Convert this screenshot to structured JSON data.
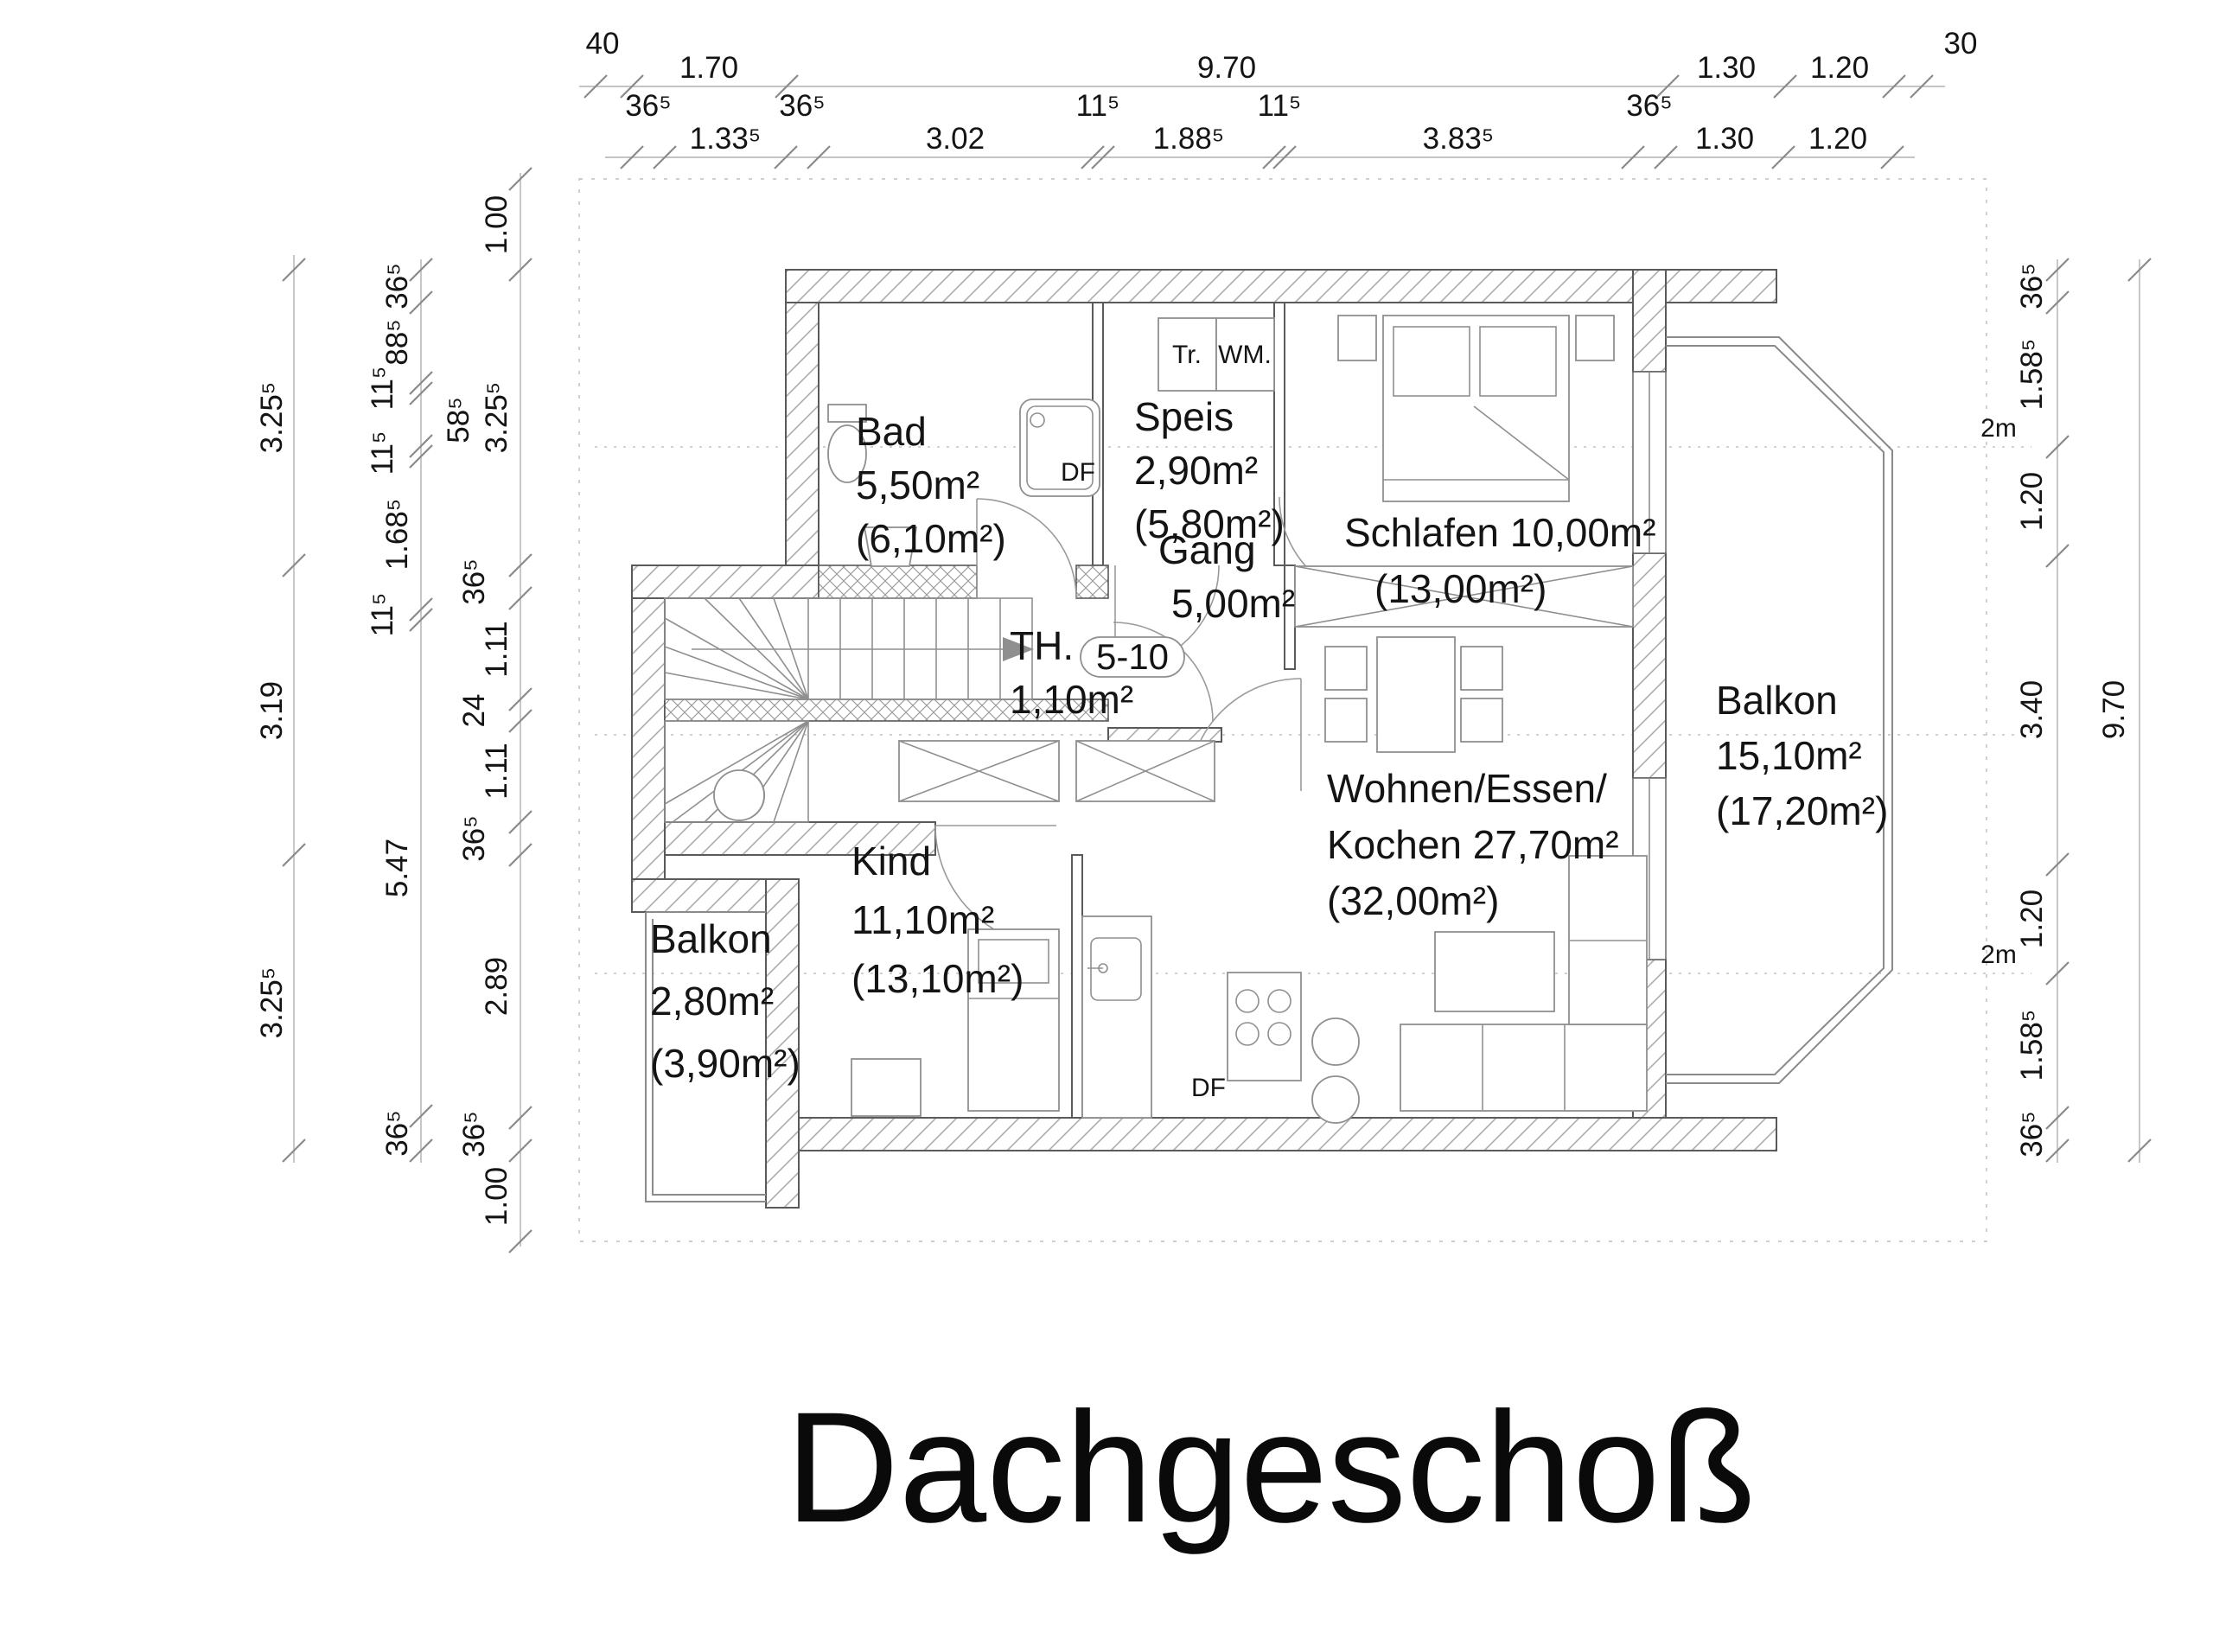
{
  "title": "Dachgeschoß",
  "dims": {
    "top": {
      "corner_left": "40",
      "corner_right": "30",
      "row1": [
        "1.70",
        "9.70",
        "1.30",
        "1.20"
      ],
      "row2": [
        "36⁵",
        "36⁵",
        "11⁵",
        "11⁵",
        "36⁵"
      ],
      "row3": [
        "1.33⁵",
        "3.02",
        "1.88⁵",
        "3.83⁵",
        "1.30",
        "1.20"
      ]
    },
    "left": {
      "outer": [
        "3.25⁵",
        "3.19",
        "3.25⁵"
      ],
      "mid": [
        "36⁵",
        "88⁵",
        "11⁵",
        "58⁵",
        "11⁵",
        "1.68⁵",
        "11⁵",
        "5.47",
        "36⁵"
      ],
      "inner": [
        "1.00",
        "3.25⁵",
        "36⁵",
        "1.11",
        "24",
        "1.11",
        "36⁵",
        "2.89",
        "36⁵",
        "1.00"
      ]
    },
    "right": {
      "inner": [
        "36⁵",
        "1.58⁵",
        "1.20",
        "3.40",
        "1.20",
        "1.58⁵",
        "36⁵"
      ],
      "outer": "9.70"
    }
  },
  "rooms": {
    "bad": {
      "name": "Bad",
      "area": "5,50m²",
      "area_roof": "(6,10m²)"
    },
    "speis": {
      "name": "Speis",
      "area": "2,90m²",
      "area_roof": "(5,80m²)"
    },
    "gang": {
      "name": "Gang",
      "area": "5,00m²"
    },
    "schlafen": {
      "name": "Schlafen 10,00m²",
      "area_roof": "(13,00m²)"
    },
    "treppenhaus": {
      "name": "TH.",
      "area": "1,10m²",
      "stair_badge": "5-10"
    },
    "wohnen": {
      "line1": "Wohnen/Essen/",
      "line2": "Kochen 27,70m²",
      "line3": "(32,00m²)"
    },
    "kind": {
      "name": "Kind",
      "area": "11,10m²",
      "area_roof": "(13,10m²)"
    },
    "balkon_west": {
      "name": "Balkon",
      "area": "2,80m²",
      "area_roof": "(3,90m²)"
    },
    "balkon_ost": {
      "name": "Balkon",
      "area": "15,10m²",
      "area_roof": "(17,20m²)"
    }
  },
  "annotations": {
    "tr": "Tr.",
    "wm": "WM.",
    "df": "DF",
    "height_mark": "2m"
  }
}
